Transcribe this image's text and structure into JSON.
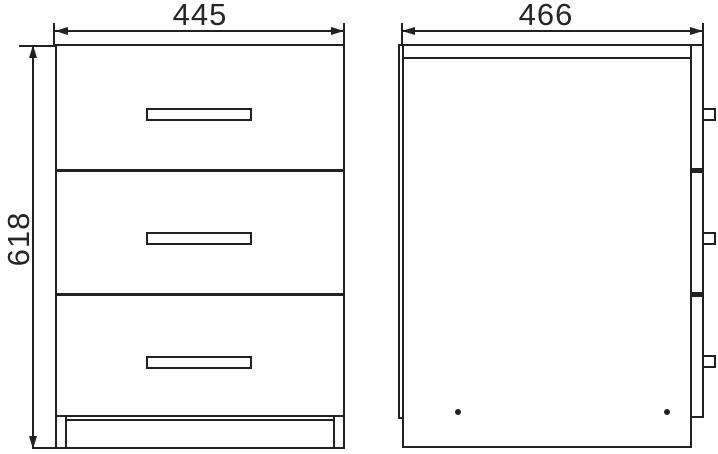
{
  "drawing": {
    "type": "furniture dimension drawing",
    "subject": "three-drawer cabinet shown in front and side orthographic views",
    "dimensions": {
      "front_width": "445",
      "front_height": "618",
      "side_depth": "466"
    },
    "front_view": {
      "drawer_count": 3,
      "handle_count": 3,
      "plinth_feet": 2
    },
    "side_view": {
      "drawer_front_segments": 3,
      "handle_tab_count": 3,
      "screw_hole_count": 2
    },
    "colors": {
      "line": "#212121",
      "background": "#fdfdfd",
      "text": "#262626"
    }
  }
}
